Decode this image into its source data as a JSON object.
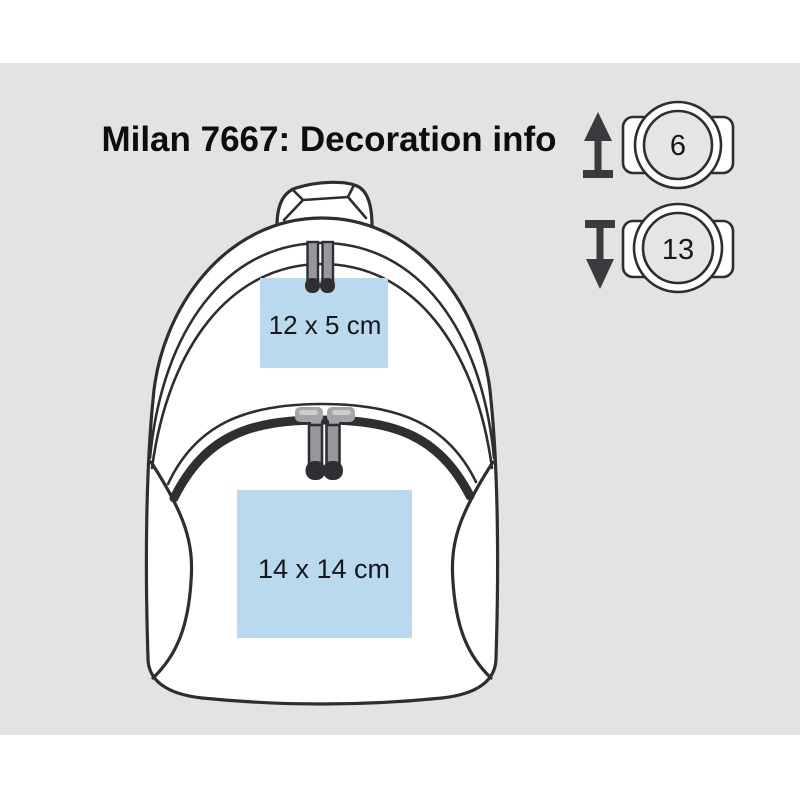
{
  "title": "Milan 7667: Decoration info",
  "print_areas": [
    {
      "location": "front-top",
      "label": "12 x 5 cm"
    },
    {
      "location": "front-pocket",
      "label": "14 x 14 cm"
    }
  ],
  "size_badges": [
    {
      "value": "6",
      "arrow_icon": "arrow-up"
    },
    {
      "value": "13",
      "arrow_icon": "arrow-down"
    }
  ],
  "colors": {
    "background": "#e3e3e3",
    "outline": "#2e2e32",
    "print_area": "#b9d9ef",
    "badge_inner": "#e5e5e7",
    "arrow": "#3b3b3f"
  }
}
